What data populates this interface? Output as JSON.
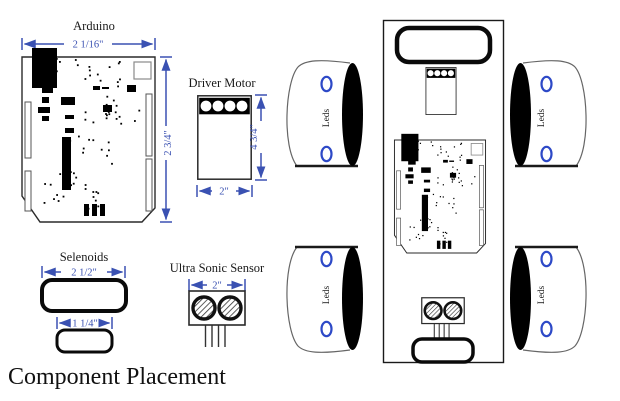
{
  "title": "Component Placement",
  "colors": {
    "dimension_blue": "#3a51b2",
    "led_blue": "#2d49c7"
  },
  "components": {
    "arduino": {
      "label": "Arduino",
      "width": "2 1/16\"",
      "height": "2 3/4\""
    },
    "driver_motor": {
      "label": "Driver Motor",
      "width": "2\"",
      "height": "4 3/4\""
    },
    "selenoids": {
      "label": "Selenoids",
      "large_width": "2 1/2\"",
      "small_width": "1 1/4\""
    },
    "ultrasonic": {
      "label": "Ultra Sonic Sensor",
      "width": "2\""
    },
    "leds": {
      "label": "Leds"
    }
  }
}
